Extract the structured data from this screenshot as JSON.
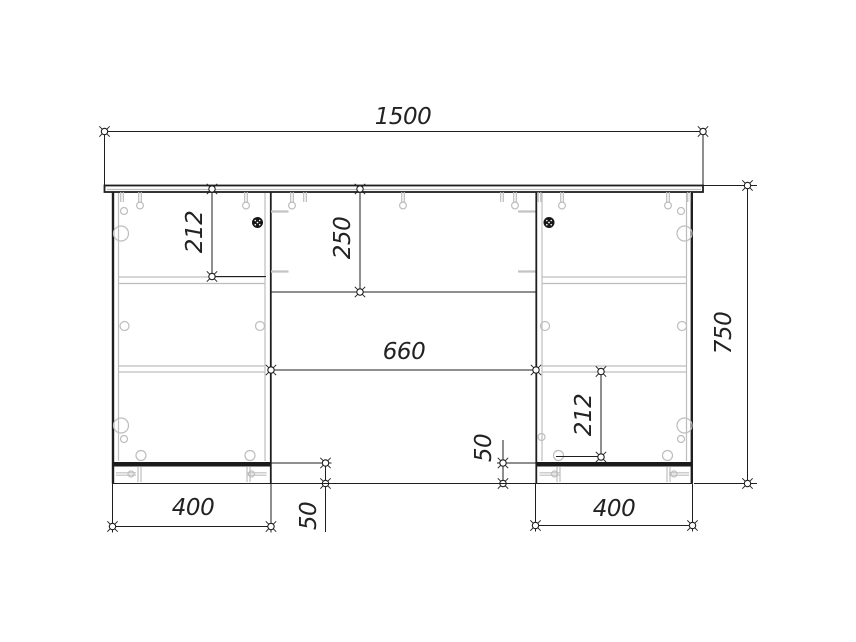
{
  "drawing": {
    "type": "furniture-technical-drawing",
    "view": "front-elevation-desk-with-two-pedestals",
    "units": "mm",
    "dimensions": {
      "overall_width": "1500",
      "overall_height": "750",
      "left_drawer_height": "212",
      "center_drawer_height": "250",
      "knee_space_width": "660",
      "right_compartment_height": "212",
      "left_pedestal_width": "400",
      "right_pedestal_width": "400",
      "left_plinth_height": "50",
      "right_plinth_height": "50"
    },
    "colors": {
      "outline": "#1f1f1f",
      "hardware_detail": "#bdbdbd",
      "background": "#ffffff"
    }
  }
}
